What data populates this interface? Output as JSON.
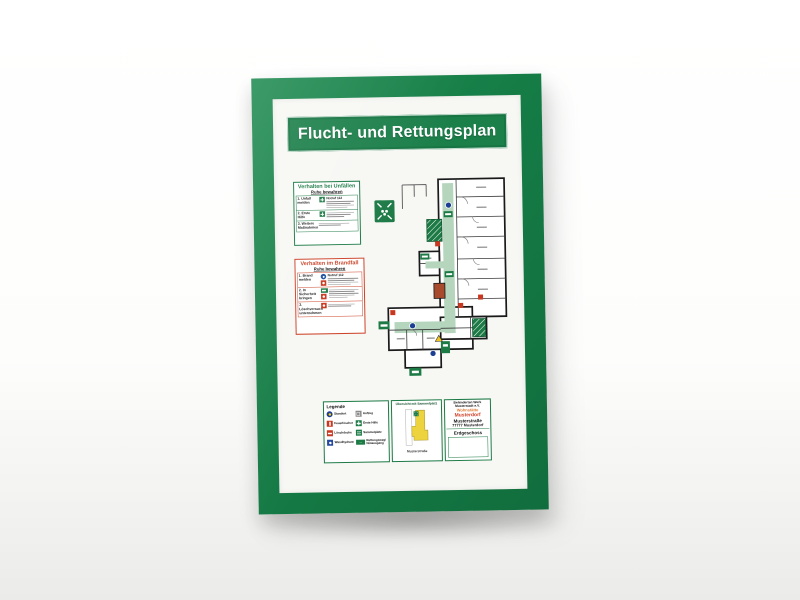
{
  "photo": {
    "frame_color": "#157c46",
    "safety_green": "#1c7a45",
    "alarm_red": "#cc4328",
    "route_green": "#b5d6bd",
    "overview_yellow": "#edd43f"
  },
  "plan": {
    "title": "Flucht- und Rettungsplan",
    "accident_box": {
      "title": "Verhalten bei Unfällen",
      "subtitle": "Ruhe bewahren",
      "rows": [
        {
          "label": "1. Unfall melden",
          "note": "Notruf 112"
        },
        {
          "label": "2. Erste Hilfe",
          "note": ""
        },
        {
          "label": "3. Weitere Maßnahmen",
          "note": ""
        }
      ]
    },
    "fire_box": {
      "title": "Verhalten im Brandfall",
      "subtitle": "Ruhe bewahren",
      "rows": [
        {
          "label": "1. Brand melden",
          "note": "Notruf 112"
        },
        {
          "label": "2. In Sicherheit bringen",
          "note": ""
        },
        {
          "label": "3. Löschversuch unternehmen",
          "note": ""
        }
      ]
    },
    "legend": {
      "title": "Legende",
      "left": [
        {
          "label": "Standort"
        },
        {
          "label": "Feuerlöscher"
        },
        {
          "label": "Löschdecke"
        },
        {
          "label": "Wandhydrant"
        }
      ],
      "right": [
        {
          "label": "Aufzug"
        },
        {
          "label": "Erste Hilfe"
        },
        {
          "label": "Sammelplatz"
        },
        {
          "label": "Rettungsweg/ Notausgang"
        }
      ]
    },
    "overview": {
      "title": "Übersicht mit Sammelplatz",
      "caption": "Musterstraße"
    },
    "info_box": {
      "org_line1": "Behinderten Werk",
      "org_line2": "Musterstadt e.V.",
      "facility": "Wohnstätte",
      "facility_place": "Musterdorf",
      "street": "Musterstraße",
      "city": "77777 Musterdorf",
      "floor": "Erdgeschoss"
    }
  }
}
